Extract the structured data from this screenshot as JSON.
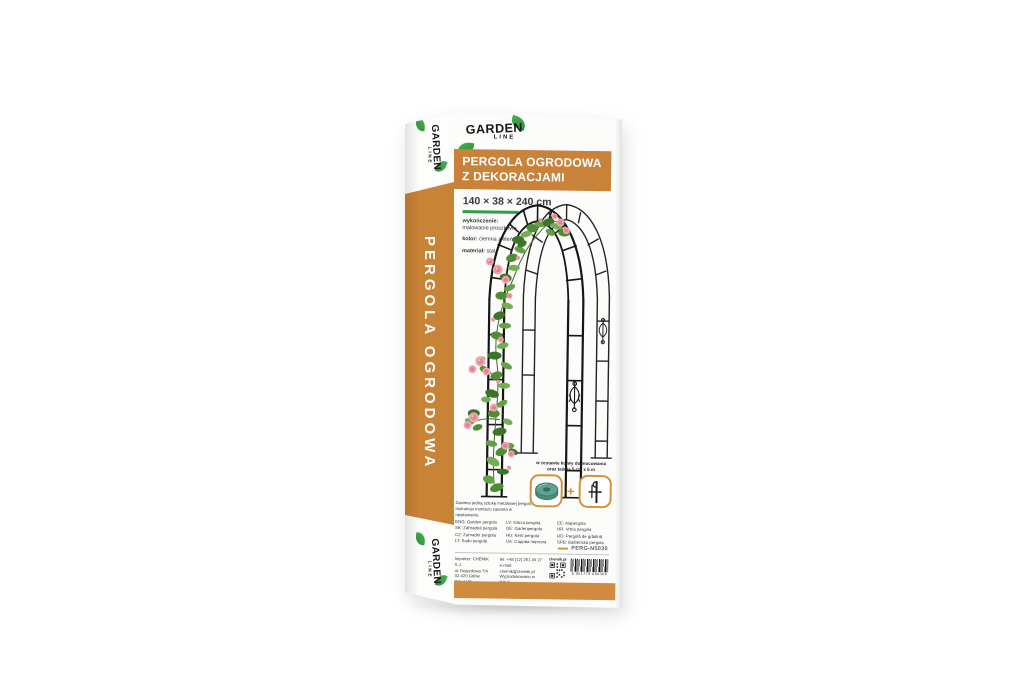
{
  "colors": {
    "accent_orange": "#c98336",
    "title_band_orange": "#c8823a",
    "bottom_strip_orange": "#cf8c40",
    "brand_green": "#2f9e41",
    "frame_black": "#1d1d1d",
    "rose_pink": "#efa3ac"
  },
  "brand": {
    "garden": "GARDEN",
    "line": "LINE"
  },
  "side_panel": {
    "vertical_text": "PERGOLA OGRODOWA"
  },
  "front": {
    "title_line1": "PERGOLA OGRODOWA",
    "title_line2": "Z DEKORACJAMI",
    "dimensions": "140 × 38 × 240 cm",
    "specs": [
      {
        "label": "wykończenie:",
        "value": "malowanie proszkowe"
      },
      {
        "label": "kolor:",
        "value": "ciemna zieleń"
      },
      {
        "label": "materiał:",
        "value": "stal"
      }
    ],
    "included_note_line1": "w zestawie kotwy do mocowania",
    "included_note_line2": "oraz taśma 5 cm x 5 m",
    "plus_sign": "+",
    "contents_note_line1": "Zawiera jedną sztukę metalowej pergoli.",
    "contents_note_line2": "Instrukcja montażu zawarta w opakowaniu.",
    "languages": [
      [
        "ENG: Garden pergola",
        "SK: Záhradná pergola",
        "CZ: Zahradní pergola",
        "LT: Sodo pergolė"
      ],
      [
        "LV: Dārza pergola",
        "DE: Gartenpergola",
        "HU: Kerti pergola",
        "UA: Садова пергола"
      ],
      [
        "EE: Aiapergola",
        "HR: Vrtna pergola",
        "RO: Pergolă de grădină",
        "SRB: Baštenska pergola"
      ]
    ],
    "product_code": "PERG-N5030",
    "importer_line1": "Importer: CHEMIK S.J.",
    "importer_line2": "ul. Dojazdowa 7/4",
    "importer_line3": "32-420 Gdów, POLAND",
    "contact_line1": "tel. +48 (12) 251 40 27",
    "contact_line2": "e-mail: chemik@chemik.pl",
    "contact_line3": "Wyprodukowano w P.R.C.",
    "qr_label": "chemik.pl",
    "barcode_number": "5 901779 050306"
  },
  "icons": {
    "leaf": "leaf-icon",
    "tape": "tape-roll-icon",
    "anchor": "ground-anchor-icon",
    "qr": "qr-code-icon",
    "barcode": "barcode-icon",
    "pergola": "pergola-illustration"
  }
}
